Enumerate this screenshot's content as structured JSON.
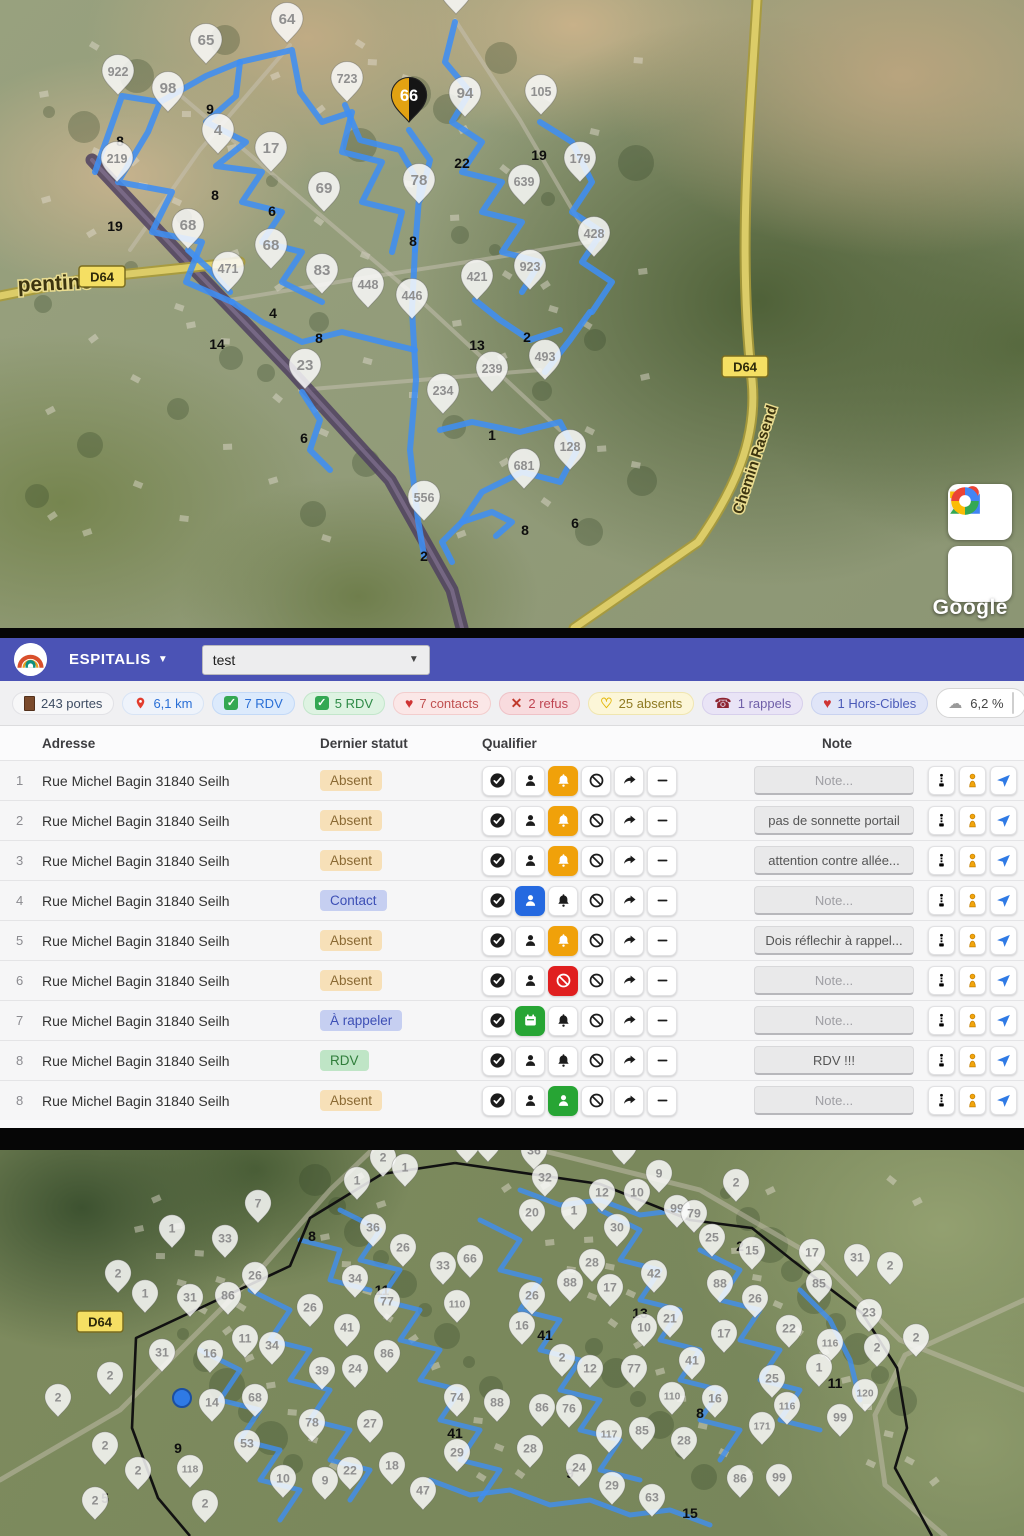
{
  "header": {
    "brand": "ESPITALIS",
    "route_select": "test"
  },
  "stats": {
    "items": [
      {
        "key": "portes",
        "icon": "door",
        "label": "243 portes",
        "bg": "#f7f7f8",
        "border": "#e2e2e6",
        "color": "#3f4d63"
      },
      {
        "key": "km",
        "icon": "pin",
        "label": "6,1 km",
        "bg": "#eef3fb",
        "border": "#d8e4f5",
        "color": "#2a6fd6"
      },
      {
        "key": "rdv-blue",
        "icon": "check",
        "label": "7 RDV",
        "bg": "#dceafc",
        "border": "#c3d9f7",
        "color": "#2a6fd6"
      },
      {
        "key": "rdv-green",
        "icon": "check",
        "label": "5 RDV",
        "bg": "#def3e2",
        "border": "#c3e6cb",
        "color": "#2e8b47"
      },
      {
        "key": "contacts",
        "icon": "heart",
        "label": "7 contacts",
        "bg": "#fbe7e7",
        "border": "#f3cdcd",
        "color": "#c05050"
      },
      {
        "key": "refus",
        "icon": "x",
        "label": "2 refus",
        "bg": "#f8dbde",
        "border": "#efc2c7",
        "color": "#bf4552"
      },
      {
        "key": "absents",
        "icon": "heart-outline",
        "label": "25 absents",
        "bg": "#fcf6d8",
        "border": "#f0e6b0",
        "color": "#8f7a22"
      },
      {
        "key": "rappels",
        "icon": "phone",
        "label": "1 rappels",
        "bg": "#e9e4f6",
        "border": "#d7cfec",
        "color": "#6f5fa8"
      },
      {
        "key": "hors-cibles",
        "icon": "heart",
        "label": "1 Hors-Cibles",
        "bg": "#e0e5f8",
        "border": "#c9d2f0",
        "color": "#4a5ab8"
      }
    ],
    "progress": {
      "icon": "cloud",
      "label": "6,2 %",
      "pct": 6.2,
      "color": "#444444"
    }
  },
  "table": {
    "columns": {
      "address": "Adresse",
      "status": "Dernier statut",
      "qualifier": "Qualifier",
      "note": "Note"
    },
    "note_placeholder": "Note...",
    "rows": [
      {
        "num": "1",
        "address": "Rue Michel Bagin 31840 Seilh",
        "status": "Absent",
        "status_type": "absent",
        "active_slot": 2,
        "active_color": "#f0a10a",
        "active_icon": "bell",
        "note": ""
      },
      {
        "num": "2",
        "address": "Rue Michel Bagin 31840 Seilh",
        "status": "Absent",
        "status_type": "absent",
        "active_slot": 2,
        "active_color": "#f0a10a",
        "active_icon": "bell",
        "note": "pas de sonnette portail"
      },
      {
        "num": "3",
        "address": "Rue Michel Bagin 31840 Seilh",
        "status": "Absent",
        "status_type": "absent",
        "active_slot": 2,
        "active_color": "#f0a10a",
        "active_icon": "bell",
        "note": "attention contre allée..."
      },
      {
        "num": "4",
        "address": "Rue Michel Bagin 31840 Seilh",
        "status": "Contact",
        "status_type": "contact",
        "active_slot": 1,
        "active_color": "#2569e0",
        "active_icon": "person",
        "note": ""
      },
      {
        "num": "5",
        "address": "Rue Michel Bagin 31840 Seilh",
        "status": "Absent",
        "status_type": "absent",
        "active_slot": 2,
        "active_color": "#f0a10a",
        "active_icon": "bell",
        "note": "Dois réflechir à rappel..."
      },
      {
        "num": "6",
        "address": "Rue Michel Bagin 31840 Seilh",
        "status": "Absent",
        "status_type": "absent",
        "active_slot": 2,
        "active_color": "#e01f1f",
        "active_icon": "no",
        "note": ""
      },
      {
        "num": "7",
        "address": "Rue Michel Bagin 31840 Seilh",
        "status": "À rappeler",
        "status_type": "rappeler",
        "active_slot": 1,
        "active_color": "#27a534",
        "active_icon": "cal",
        "note": ""
      },
      {
        "num": "8",
        "address": "Rue Michel Bagin 31840 Seilh",
        "status": "RDV",
        "status_type": "rdv",
        "active_slot": -1,
        "active_color": "",
        "active_icon": "",
        "note": "RDV !!!"
      },
      {
        "num": "8",
        "address": "Rue Michel Bagin 31840 Seilh",
        "status": "Absent",
        "status_type": "absent",
        "active_slot": 2,
        "active_color": "#27a534",
        "active_icon": "person",
        "note": ""
      }
    ]
  },
  "map_top": {
    "google_logo": "Google",
    "road_badges": [
      {
        "t": "D64",
        "x": 102,
        "y": 277
      },
      {
        "t": "D64",
        "x": 745,
        "y": 367
      }
    ],
    "street_labels": [
      {
        "t": "pentine",
        "x": 18,
        "y": 292,
        "rot": -3,
        "size": 21
      },
      {
        "t": "Chemin Rasend",
        "x": 742,
        "y": 515,
        "rot": -72,
        "size": 15
      }
    ],
    "selected_pin": {
      "n": "66",
      "x": 409,
      "y": 122
    },
    "pins": [
      [
        456,
        14,
        "86"
      ],
      [
        287,
        43,
        "64"
      ],
      [
        206,
        64,
        "65"
      ],
      [
        168,
        112,
        "98"
      ],
      [
        118,
        95,
        "922"
      ],
      [
        347,
        102,
        "723"
      ],
      [
        465,
        117,
        "94"
      ],
      [
        541,
        115,
        "105"
      ],
      [
        218,
        154,
        "4"
      ],
      [
        271,
        172,
        "17"
      ],
      [
        117,
        182,
        "219"
      ],
      [
        580,
        182,
        "179"
      ],
      [
        419,
        204,
        "78"
      ],
      [
        524,
        205,
        "639"
      ],
      [
        324,
        212,
        "69"
      ],
      [
        188,
        249,
        "68"
      ],
      [
        271,
        269,
        "68"
      ],
      [
        594,
        257,
        "428"
      ],
      [
        530,
        290,
        "923"
      ],
      [
        322,
        294,
        "83"
      ],
      [
        368,
        308,
        "448"
      ],
      [
        477,
        300,
        "421"
      ],
      [
        412,
        319,
        "446"
      ],
      [
        228,
        292,
        "471"
      ],
      [
        305,
        389,
        "23"
      ],
      [
        492,
        392,
        "239"
      ],
      [
        545,
        380,
        "493"
      ],
      [
        443,
        414,
        "234"
      ],
      [
        570,
        470,
        "128"
      ],
      [
        524,
        489,
        "681"
      ],
      [
        424,
        521,
        "556"
      ]
    ],
    "labels": [
      [
        210,
        114,
        "9"
      ],
      [
        120,
        146,
        "8"
      ],
      [
        215,
        200,
        "8"
      ],
      [
        272,
        216,
        "6"
      ],
      [
        115,
        231,
        "19"
      ],
      [
        462,
        168,
        "22"
      ],
      [
        539,
        160,
        "19"
      ],
      [
        413,
        246,
        "8"
      ],
      [
        217,
        349,
        "14"
      ],
      [
        273,
        318,
        "4"
      ],
      [
        319,
        343,
        "8"
      ],
      [
        477,
        350,
        "13"
      ],
      [
        527,
        342,
        "2"
      ],
      [
        304,
        443,
        "6"
      ],
      [
        492,
        440,
        "1"
      ],
      [
        525,
        535,
        "8"
      ],
      [
        575,
        528,
        "6"
      ],
      [
        424,
        561,
        "2"
      ]
    ]
  },
  "map_bottom": {
    "road_badges": [
      {
        "t": "D64",
        "x": 100,
        "y": 172
      }
    ],
    "dot": {
      "x": 182,
      "y": 248
    },
    "pins": [
      [
        383,
        27,
        "2"
      ],
      [
        467,
        13,
        "76"
      ],
      [
        488,
        12,
        "9"
      ],
      [
        534,
        20,
        "36"
      ],
      [
        624,
        15,
        "2"
      ],
      [
        405,
        37,
        "1"
      ],
      [
        357,
        50,
        "1"
      ],
      [
        659,
        43,
        "9"
      ],
      [
        736,
        52,
        "2"
      ],
      [
        545,
        47,
        "32"
      ],
      [
        602,
        62,
        "12"
      ],
      [
        637,
        62,
        "10"
      ],
      [
        677,
        78,
        "99"
      ],
      [
        694,
        83,
        "79"
      ],
      [
        532,
        82,
        "20"
      ],
      [
        574,
        80,
        "1"
      ],
      [
        617,
        97,
        "30"
      ],
      [
        712,
        107,
        "25"
      ],
      [
        752,
        120,
        "15"
      ],
      [
        812,
        122,
        "17"
      ],
      [
        857,
        127,
        "31"
      ],
      [
        890,
        135,
        "2"
      ],
      [
        373,
        97,
        "36"
      ],
      [
        403,
        117,
        "26"
      ],
      [
        443,
        135,
        "33"
      ],
      [
        470,
        128,
        "66"
      ],
      [
        258,
        73,
        "7"
      ],
      [
        172,
        98,
        "1"
      ],
      [
        225,
        108,
        "33"
      ],
      [
        118,
        143,
        "2"
      ],
      [
        145,
        163,
        "1"
      ],
      [
        190,
        167,
        "31"
      ],
      [
        228,
        165,
        "86"
      ],
      [
        255,
        145,
        "26"
      ],
      [
        310,
        177,
        "26"
      ],
      [
        355,
        148,
        "34"
      ],
      [
        387,
        171,
        "77"
      ],
      [
        457,
        173,
        "110"
      ],
      [
        592,
        132,
        "28"
      ],
      [
        570,
        152,
        "88"
      ],
      [
        610,
        157,
        "17"
      ],
      [
        654,
        143,
        "42"
      ],
      [
        720,
        153,
        "88"
      ],
      [
        819,
        153,
        "85"
      ],
      [
        755,
        168,
        "26"
      ],
      [
        869,
        182,
        "23"
      ],
      [
        532,
        165,
        "26"
      ],
      [
        347,
        197,
        "41"
      ],
      [
        522,
        195,
        "16"
      ],
      [
        644,
        197,
        "10"
      ],
      [
        670,
        188,
        "21"
      ],
      [
        724,
        203,
        "17"
      ],
      [
        789,
        198,
        "22"
      ],
      [
        830,
        212,
        "116"
      ],
      [
        877,
        217,
        "2"
      ],
      [
        916,
        207,
        "2"
      ],
      [
        162,
        222,
        "31"
      ],
      [
        210,
        223,
        "16"
      ],
      [
        245,
        208,
        "11"
      ],
      [
        272,
        215,
        "34"
      ],
      [
        322,
        240,
        "39"
      ],
      [
        355,
        238,
        "24"
      ],
      [
        387,
        223,
        "86"
      ],
      [
        562,
        227,
        "2"
      ],
      [
        590,
        238,
        "12"
      ],
      [
        634,
        238,
        "77"
      ],
      [
        692,
        230,
        "41"
      ],
      [
        772,
        248,
        "25"
      ],
      [
        819,
        237,
        "1"
      ],
      [
        865,
        262,
        "120"
      ],
      [
        457,
        267,
        "74"
      ],
      [
        497,
        272,
        "88"
      ],
      [
        672,
        265,
        "110"
      ],
      [
        715,
        268,
        "16"
      ],
      [
        787,
        275,
        "116"
      ],
      [
        542,
        277,
        "86"
      ],
      [
        569,
        278,
        "76"
      ],
      [
        840,
        287,
        "99"
      ],
      [
        212,
        272,
        "14"
      ],
      [
        255,
        267,
        "68"
      ],
      [
        110,
        245,
        "2"
      ],
      [
        58,
        267,
        "2"
      ],
      [
        105,
        315,
        "2"
      ],
      [
        138,
        340,
        "2"
      ],
      [
        247,
        313,
        "53"
      ],
      [
        190,
        338,
        "118"
      ],
      [
        283,
        348,
        "10"
      ],
      [
        325,
        350,
        "9"
      ],
      [
        392,
        335,
        "18"
      ],
      [
        350,
        340,
        "22"
      ],
      [
        423,
        360,
        "47"
      ],
      [
        457,
        322,
        "29"
      ],
      [
        370,
        293,
        "27"
      ],
      [
        312,
        292,
        "78"
      ],
      [
        609,
        303,
        "117"
      ],
      [
        642,
        300,
        "85"
      ],
      [
        684,
        310,
        "28"
      ],
      [
        762,
        295,
        "171"
      ],
      [
        579,
        337,
        "24"
      ],
      [
        530,
        318,
        "28"
      ],
      [
        612,
        355,
        "29"
      ],
      [
        652,
        367,
        "63"
      ],
      [
        740,
        348,
        "86"
      ],
      [
        779,
        347,
        "99"
      ],
      [
        205,
        373,
        "2"
      ],
      [
        95,
        370,
        "2"
      ]
    ],
    "labels": [
      [
        178,
        303,
        "9"
      ],
      [
        105,
        353,
        "5"
      ],
      [
        312,
        91,
        "8"
      ],
      [
        382,
        145,
        "11"
      ],
      [
        640,
        168,
        "13"
      ],
      [
        740,
        101,
        "2"
      ],
      [
        545,
        190,
        "41"
      ],
      [
        700,
        268,
        "8"
      ],
      [
        835,
        238,
        "11"
      ],
      [
        570,
        328,
        "9"
      ],
      [
        690,
        368,
        "15"
      ],
      [
        455,
        288,
        "41"
      ]
    ]
  }
}
